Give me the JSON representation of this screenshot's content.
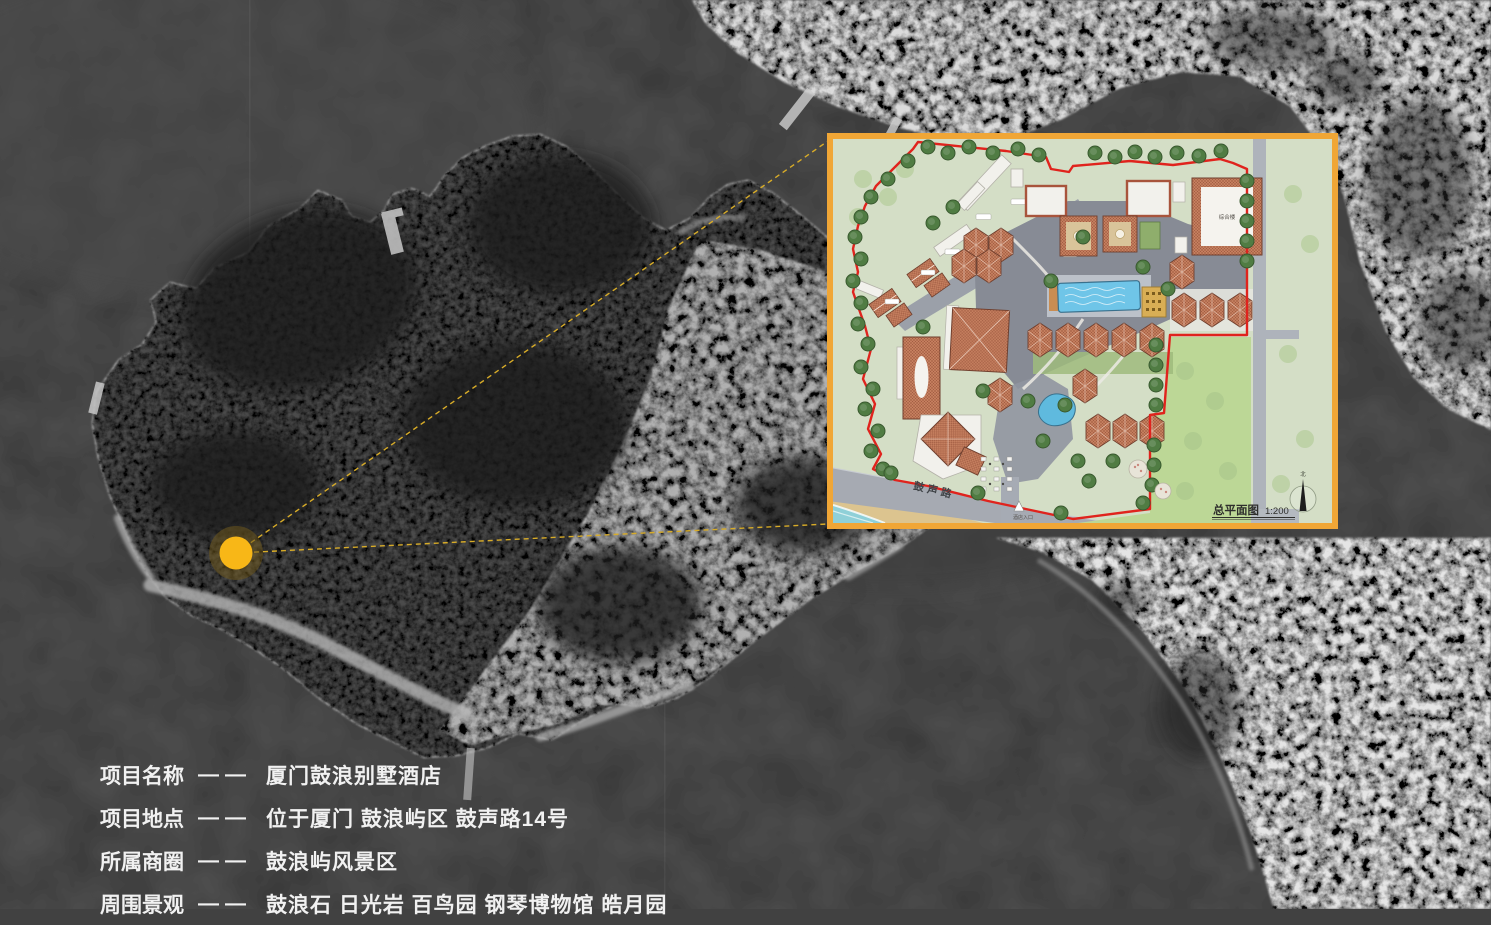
{
  "project_info": {
    "rows": [
      {
        "label": "项目名称",
        "dash": "——",
        "value": "厦门鼓浪别墅酒店"
      },
      {
        "label": "项目地点",
        "dash": "——",
        "value": "位于厦门 鼓浪屿区 鼓声路14号"
      },
      {
        "label": "所属商圈",
        "dash": "——",
        "value": "鼓浪屿风景区"
      },
      {
        "label": "周围景观",
        "dash": "——",
        "value": "鼓浪石 日光岩 百鸟园 钢琴博物馆 皓月园"
      }
    ]
  },
  "site_plan": {
    "title": "总平面图",
    "scale": "1:200",
    "road_label": "鼓声路",
    "entrance_label": "酒店入口",
    "north_label": "北",
    "building_label": "综合楼",
    "border_color": "#F0A636",
    "boundary_color": "#E0231D",
    "background_color": "#D4DEC6"
  },
  "map": {
    "marker_color": "#F8B717",
    "marker_halo_color": "rgba(110,88,30,0.55)",
    "callout_line_color": "#D8AC28"
  }
}
